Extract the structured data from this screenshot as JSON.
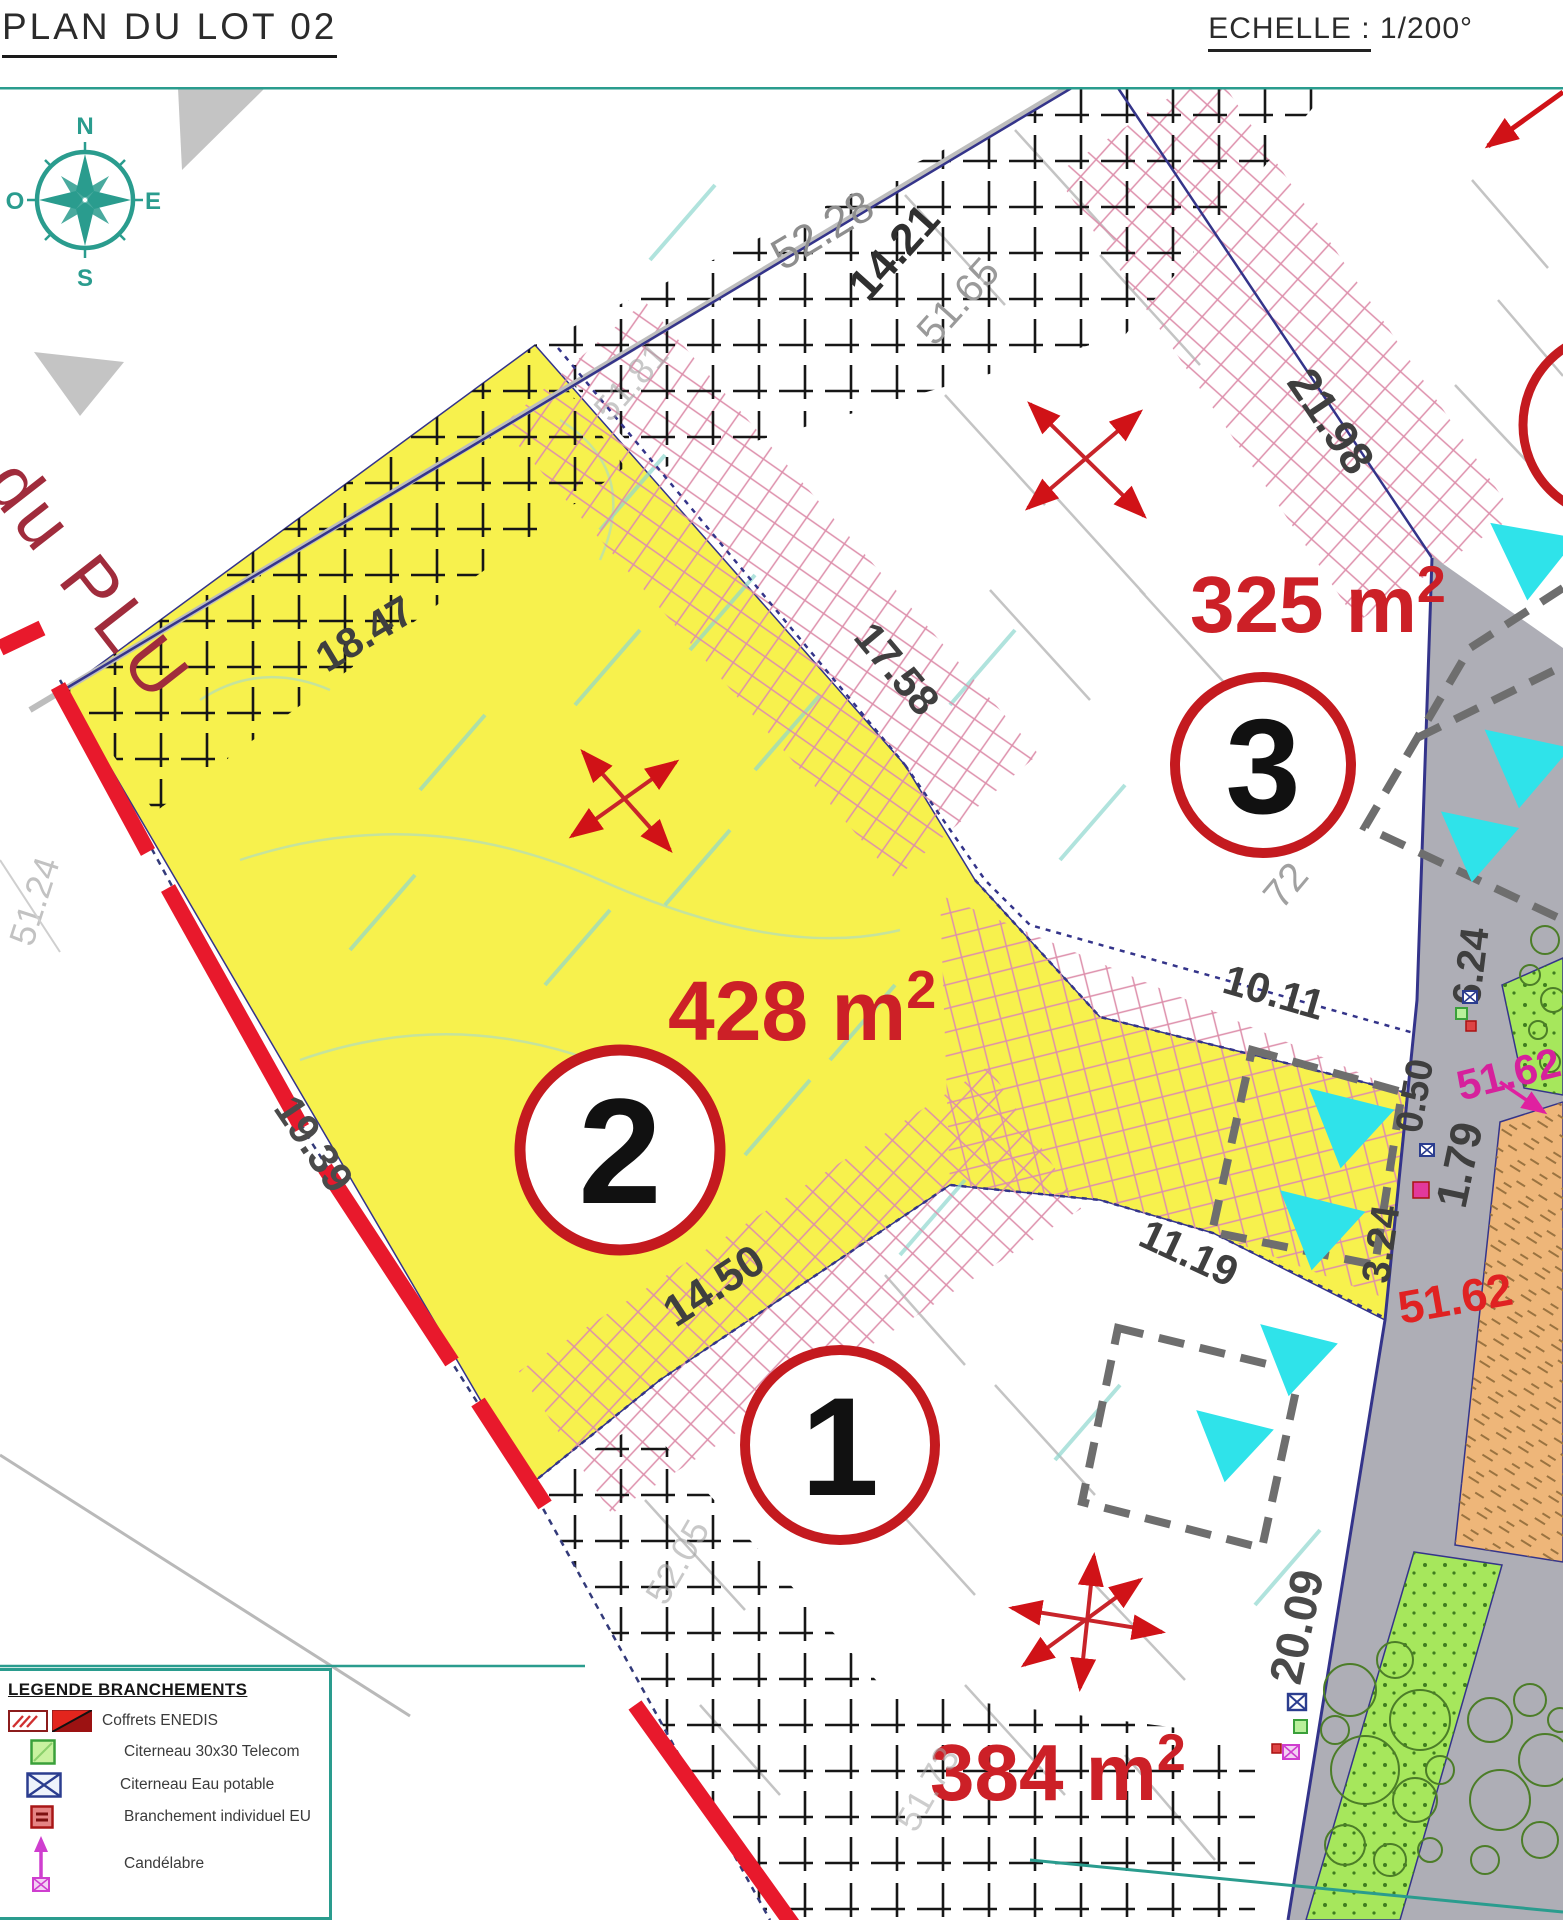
{
  "header": {
    "title": "PLAN DU LOT 02",
    "scale_label": "ECHELLE :",
    "scale_value": " 1/200°"
  },
  "compass": {
    "north": "N",
    "south": "S",
    "east": "E",
    "west": "O"
  },
  "zone_label": "du PLU",
  "lots": [
    {
      "number": "1",
      "area": "384 m",
      "area_exp": "2"
    },
    {
      "number": "2",
      "area": "428 m",
      "area_exp": "2"
    },
    {
      "number": "3",
      "area": "325 m",
      "area_exp": "2"
    }
  ],
  "dimensions": [
    {
      "value": "52.28"
    },
    {
      "value": "14.21"
    },
    {
      "value": "51.65"
    },
    {
      "value": "21.98"
    },
    {
      "value": "18.47"
    },
    {
      "value": "17.58"
    },
    {
      "value": "10.11"
    },
    {
      "value": "11.19"
    },
    {
      "value": "6.24"
    },
    {
      "value": "0.50"
    },
    {
      "value": "1.79"
    },
    {
      "value": "3.24"
    },
    {
      "value": "14.50"
    },
    {
      "value": "19.39"
    },
    {
      "value": "20.09"
    },
    {
      "value": "51.62"
    },
    {
      "value": "51.62"
    },
    {
      "value": "51.24"
    },
    {
      "value": "51.81"
    },
    {
      "value": "52.05"
    },
    {
      "value": "51.73"
    },
    {
      "value": "72"
    }
  ],
  "legend": {
    "title": "LEGENDE BRANCHEMENTS",
    "items": [
      {
        "label": "Coffrets ENEDIS",
        "symbol": "enedis-coffret-icon"
      },
      {
        "label": "Citerneau 30x30 Telecom",
        "symbol": "telecom-citerneau-icon"
      },
      {
        "label": "Citerneau Eau potable",
        "symbol": "eau-potable-citerneau-icon"
      },
      {
        "label": "Branchement individuel EU",
        "symbol": "branchement-eu-icon"
      },
      {
        "label": "Candélabre",
        "symbol": "candelabre-icon"
      }
    ]
  },
  "colors": {
    "lot_fill": "#f7f14d",
    "boundary_red": "#e8192c",
    "accent_teal": "#2a9c8e",
    "dimension_red": "#cc2027",
    "cyan_marker": "#2fe3ea",
    "pink_hatch": "#dd8fab",
    "road_gray": "#aeaeb6",
    "green_strip": "#a6e75c",
    "magenta": "#e020a0"
  }
}
